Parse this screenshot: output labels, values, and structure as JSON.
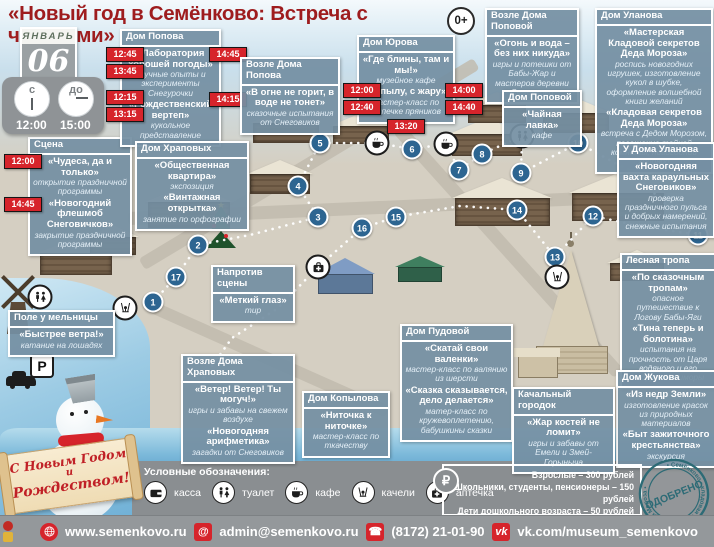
{
  "title": "«Новый год в Семёнково: Встреча с чудесами»",
  "age_badge": "0+",
  "calendar": {
    "month": "ЯНВАРЬ",
    "day": "06",
    "from_label": "с",
    "from_time": "12:00",
    "to_label": "до",
    "to_time": "15:00"
  },
  "callouts": {
    "scena": {
      "header": "Сцена",
      "times": [
        "12:00",
        "14:45"
      ],
      "items": [
        {
          "title": "«Чудеса, да и только»",
          "desc": "открытие праздничной программы"
        },
        {
          "title": "«Новогодний флешмоб Снеговичков»",
          "desc": "закрытие праздничной программы"
        }
      ]
    },
    "dom_popova": {
      "header": "Дом Попова",
      "times_left": [
        "12:45",
        "13:45",
        "12:15",
        "13:15"
      ],
      "times_right": [
        "14:45",
        "14:15"
      ],
      "items": [
        {
          "title": "«Лаборатория хорошей погоды»",
          "desc": "научные опыты и эксперименты Снегурочки"
        },
        {
          "title": "«Рождественский вертеп»",
          "desc": "кукольное представление"
        }
      ]
    },
    "vozle_doma_popova": {
      "header": "Возле Дома Попова",
      "items": [
        {
          "title": "«В огне не горит, в воде не тонет»",
          "desc": "сказочные испытания от Снеговиков"
        }
      ]
    },
    "dom_yurova": {
      "header": "Дом Юрова",
      "times_left": [
        "12:00",
        "12:40"
      ],
      "times_right": [
        "14:00",
        "14:40"
      ],
      "time_bottom": "13:20",
      "items": [
        {
          "title": "«Где блины, там и мы!»",
          "desc": "музейное кафе"
        },
        {
          "title": "«С пылу, с жару»",
          "desc": "мастер-класс по выпечке пряников"
        }
      ]
    },
    "vozle_doma_popovoy": {
      "header": "Возле Дома Поповой",
      "items": [
        {
          "title": "«Огонь и вода – без них никуда»",
          "desc": "игры и потешки от Бабы-Жар и мастеров деревни Семенково"
        }
      ]
    },
    "dom_popovoy": {
      "header": "Дом Поповой",
      "items": [
        {
          "title": "«Чайная лавка»",
          "desc": "кафе"
        }
      ]
    },
    "dom_ulanova": {
      "header": "Дом Уланова",
      "items": [
        {
          "title": "«Мастерская Кладовой секретов Деда Мороза»",
          "desc": "роспись новогодних игрушек, изготовление кукол в шубке, оформление волшебной книги желаний"
        },
        {
          "title": "«Кладовая секретов Деда Мороза»",
          "desc": "встреча с Дедом Морозом, посещение тайной комнаты, новогодний хоровод"
        }
      ]
    },
    "u_doma_ulanova": {
      "header": "У Дома Уланова",
      "items": [
        {
          "title": "«Новогодняя вахта караульных Снеговиков»",
          "desc": "проверка праздничного пульса и добрых намерений, снежные испытания"
        }
      ]
    },
    "lesnaya_tropa": {
      "header": "Лесная тропа",
      "items": [
        {
          "title": "«По сказочным тропам»",
          "desc": "опасное путешествие к Логову Бабы-Яги"
        },
        {
          "title": "«Тина теперь и болотина»",
          "desc": "испытания на прочность от Царя водяного и его подруги Кикиморы"
        }
      ]
    },
    "dom_zhukova": {
      "header": "Дом Жукова",
      "items": [
        {
          "title": "«Из недр Земли»",
          "desc": "изготовление красок из природных материалов"
        },
        {
          "title": "«Быт зажиточного крестьянства»",
          "desc": "экскурсия"
        }
      ]
    },
    "dom_khrapovykh": {
      "header": "Дом Храповых",
      "items": [
        {
          "title": "«Общественная квартира»",
          "desc": "экспозиция"
        },
        {
          "title": "«Винтажная открытка»",
          "desc": "занятие по орфографии"
        }
      ]
    },
    "naprotiv_sceny": {
      "header": "Напротив сцены",
      "items": [
        {
          "title": "«Меткий глаз»",
          "desc": "тир"
        }
      ]
    },
    "pole_u_melnitsy": {
      "header": "Поле у мельницы",
      "items": [
        {
          "title": "«Быстрее ветра!»",
          "desc": "катание на лошадях"
        }
      ]
    },
    "vozle_doma_khrapovykh": {
      "header": "Возле Дома Храповых",
      "items": [
        {
          "title": "«Ветер! Ветер! Ты могуч!»",
          "desc": "игры и забавы на свежем воздухе"
        },
        {
          "title": "«Новогодняя арифметика»",
          "desc": "загадки от Снеговиков"
        }
      ]
    },
    "dom_kopylova": {
      "header": "Дом Копылова",
      "items": [
        {
          "title": "«Ниточка к ниточке»",
          "desc": "мастер-класс по ткачеству"
        }
      ]
    },
    "dom_pudovoy": {
      "header": "Дом Пудовой",
      "items": [
        {
          "title": "«Скатай свои валенки»",
          "desc": "мастер-класс по валянию из шерсти"
        },
        {
          "title": "«Сказка сказывается, дело делается»",
          "desc": "матер-класс по кружевоплетению, бабушкины сказки"
        }
      ]
    },
    "kachalny_gorodok": {
      "header": "Качальный городок",
      "items": [
        {
          "title": "«Жар костей не ломит»",
          "desc": "игры и забавы от Емели и Змей-Горыныча"
        }
      ]
    }
  },
  "map": {
    "markers": [
      {
        "n": "1",
        "x": 153,
        "y": 302
      },
      {
        "n": "2",
        "x": 198,
        "y": 245
      },
      {
        "n": "3",
        "x": 318,
        "y": 217
      },
      {
        "n": "4",
        "x": 298,
        "y": 186
      },
      {
        "n": "5",
        "x": 320,
        "y": 143
      },
      {
        "n": "6",
        "x": 412,
        "y": 149
      },
      {
        "n": "7",
        "x": 459,
        "y": 170
      },
      {
        "n": "8",
        "x": 482,
        "y": 154
      },
      {
        "n": "9",
        "x": 521,
        "y": 173
      },
      {
        "n": "10",
        "x": 578,
        "y": 143
      },
      {
        "n": "11",
        "x": 698,
        "y": 235
      },
      {
        "n": "12",
        "x": 593,
        "y": 216
      },
      {
        "n": "13",
        "x": 555,
        "y": 257
      },
      {
        "n": "14",
        "x": 517,
        "y": 210
      },
      {
        "n": "15",
        "x": 396,
        "y": 217
      },
      {
        "n": "16",
        "x": 362,
        "y": 228
      },
      {
        "n": "17",
        "x": 176,
        "y": 277
      }
    ],
    "icons": [
      {
        "name": "cafe-icon",
        "x": 377,
        "y": 143
      },
      {
        "name": "cafe-icon",
        "x": 446,
        "y": 144
      },
      {
        "name": "wc-icon",
        "x": 522,
        "y": 136
      },
      {
        "name": "wc-icon",
        "x": 40,
        "y": 297
      },
      {
        "name": "swing-icon",
        "x": 557,
        "y": 277
      },
      {
        "name": "swing-icon",
        "x": 125,
        "y": 308
      },
      {
        "name": "firstaid-icon",
        "x": 318,
        "y": 267
      }
    ],
    "parking_label": "P"
  },
  "legend": {
    "title": "Условные обозначения:",
    "items": [
      {
        "icon": "kassa-icon",
        "label": "касса"
      },
      {
        "icon": "wc-icon",
        "label": "туалет"
      },
      {
        "icon": "cafe-icon",
        "label": "кафе"
      },
      {
        "icon": "swing-icon",
        "label": "качели"
      },
      {
        "icon": "firstaid-icon",
        "label": "аптечка"
      }
    ]
  },
  "prices": {
    "currency_icon": "₽",
    "lines": [
      "Взрослые – 300 рублей",
      "Школьники, студенты, пенсионеры –  150 рублей",
      "Дети дошкольного возраста  –  50 рублей",
      "Дети до 3-х лет – бесплатно"
    ]
  },
  "stamp": {
    "text": "ОДОБРЕНО",
    "ring_text": "• Семёнково • кладовая секретов Деда Мороза •"
  },
  "greeting": {
    "line1": "С Новым Годом",
    "line2": "и",
    "line3": "Рождеством!"
  },
  "footer": {
    "website": "www.semenkovo.ru",
    "email": "admin@semenkovo.ru",
    "phone": "(8172) 21-01-90",
    "vk": "vk.com/museum_semenkovo",
    "at_glyph": "@",
    "phone_glyph": "☎",
    "vk_glyph": "vk"
  }
}
